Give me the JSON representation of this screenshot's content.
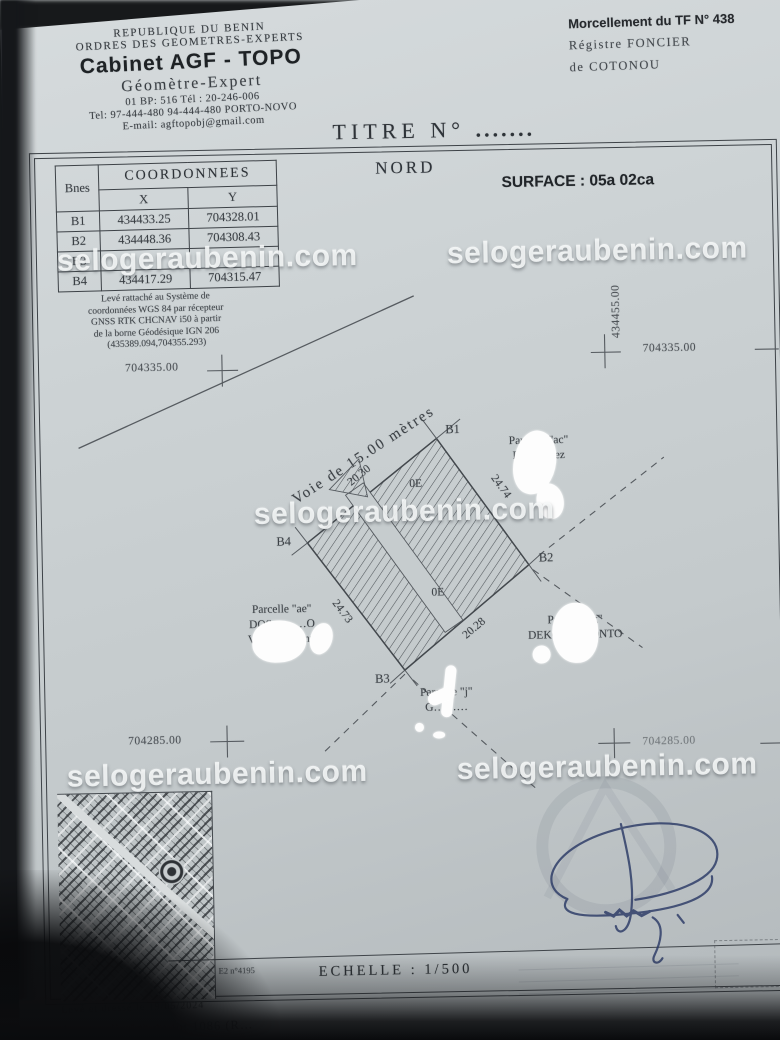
{
  "colors": {
    "paper": "#c7cdcf",
    "ink": "#3a3f44",
    "signature_ink": "#2b3a66",
    "watermark": "#f8fafa"
  },
  "watermark": {
    "text": "selogeraubenin.com"
  },
  "header": {
    "line1": "REPUBLIQUE DU BENIN",
    "line2": "ORDRES DES GEOMETRES-EXPERTS",
    "cabinet": "Cabinet AGF - TOPO",
    "subtitle": "Géomètre-Expert",
    "bp_line": "01 BP: 516 Tél : 20-246-006",
    "tel_line": "Tel: 97-444-480 94-444-480 PORTO-NOVO",
    "email_line": "E-mail: agftopobj@gmail.com"
  },
  "registry": {
    "line1": "Morcellement du TF N° 438",
    "line2": "Régistre  FONCIER",
    "line3": "de  COTONOU"
  },
  "titre": {
    "label": "TITRE  N°",
    "dots": "......."
  },
  "map_header": {
    "north": "NORD",
    "surface": "SURFACE : 05a 02ca"
  },
  "coord_table": {
    "title": "COORDONNEES",
    "col_point": "Bnes",
    "col_x": "X",
    "col_y": "Y",
    "rows": [
      {
        "b": "B1",
        "x": "434433.25",
        "y": "704328.01"
      },
      {
        "b": "B2",
        "x": "434448.36",
        "y": "704308.43"
      },
      {
        "b": "B3",
        "x": "",
        "y": ""
      },
      {
        "b": "B4",
        "x": "434417.29",
        "y": "704315.47"
      }
    ]
  },
  "datum_note": {
    "l1": "Levé rattaché au Système de",
    "l2": "coordonnées WGS 84 par récepteur",
    "l3": "GNSS RTK CHCNAV i50 à partir",
    "l4": "de la borne Géodésique IGN 206",
    "l5": "(435389.094,704355.293)"
  },
  "grid": {
    "left": "704335.00",
    "right_vertical": "434455.00",
    "right": "704335.00",
    "bottom_left": "704285.00",
    "bottom_right": "704285.00"
  },
  "plan": {
    "road": "Voie  de  15.00  mètres",
    "corners": {
      "b1": "B1",
      "b2": "B2",
      "b3": "B3",
      "b4": "B4"
    },
    "dims": {
      "b4b1": "20.30",
      "b1b2": "24.74",
      "b3b2": "20.28",
      "b4b3": "24.73"
    },
    "marks": {
      "m1": "0E",
      "m2": "0E"
    },
    "neighbor_right": {
      "l1": "Parcelle \"ac\"",
      "l2": "R………ez"
    },
    "neighbor_left": {
      "l1": "Parcelle \"ae\"",
      "l2": "DOS………O",
      "l3": "Vig………enri"
    },
    "neighbor_bottom_right": {
      "l1": "Parcelle \"k\"",
      "l2": "DEKO……BONTO"
    },
    "neighbor_bottom": {
      "l1": "Parcelle \"j\"",
      "l2": "G………"
    }
  },
  "inset": {
    "ref": "E2 n°4195"
  },
  "scale": {
    "label": "ECHELLE  :  1/500"
  },
  "footer": {
    "l1": "Levé et dressé le 19/05/2024",
    "l2": "de la parcelle \"c\" du lot 1086 (R…"
  }
}
